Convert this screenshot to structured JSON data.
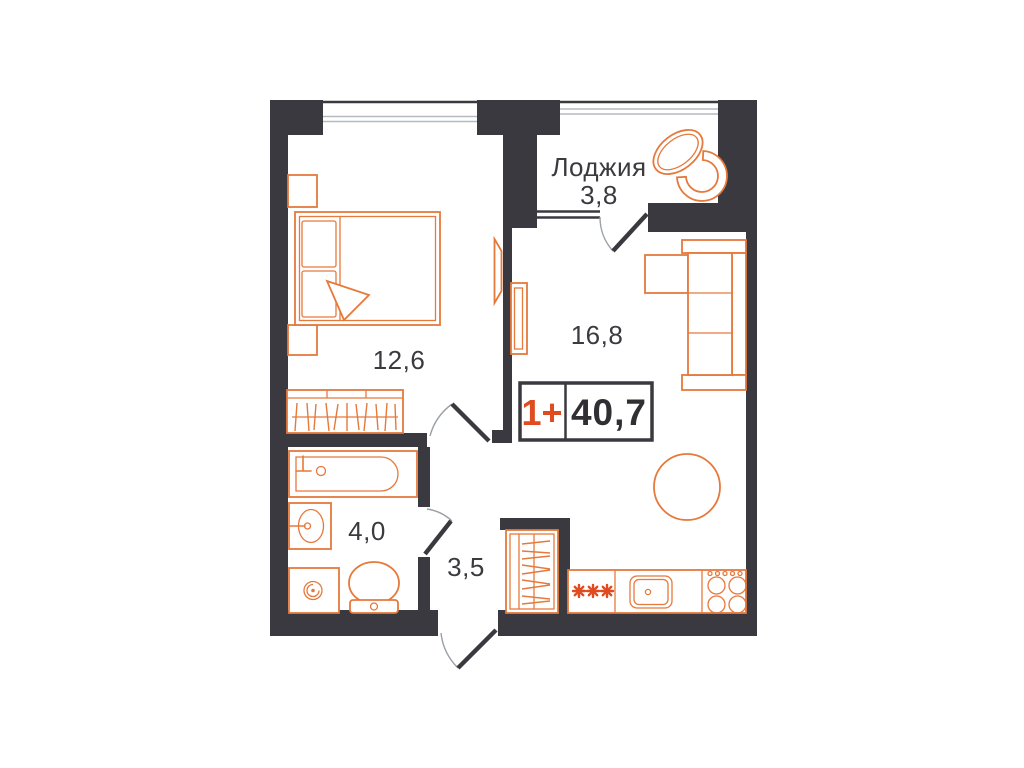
{
  "plan": {
    "title": "apartment-floor-plan",
    "badge": {
      "layout": "1+",
      "total_area": "40,7"
    },
    "rooms": {
      "bedroom": {
        "area": "12,6"
      },
      "living": {
        "area": "16,8"
      },
      "loggia": {
        "name": "Лоджия",
        "area": "3,8"
      },
      "bathroom": {
        "area": "4,0"
      },
      "hallway": {
        "area": "3,5"
      }
    },
    "symbols": [
      "double-bed",
      "pillows",
      "nightstand",
      "wardrobe-hangers",
      "tv-panel",
      "bathtub",
      "wash-basin",
      "washing-machine",
      "toilet",
      "hall-closet-hangers",
      "kitchen-counter",
      "fridge-snowflakes",
      "kitchen-sink",
      "stove-4-burners",
      "round-dining-table",
      "dining-chairs",
      "corner-sofa",
      "loggia-oval-table",
      "loggia-chair"
    ],
    "colors": {
      "walls": "#3a393f",
      "furniture_outline": "#e6793c",
      "accent": "#e04b20",
      "label_text": "#3a3a3f",
      "background": "#ffffff"
    }
  }
}
